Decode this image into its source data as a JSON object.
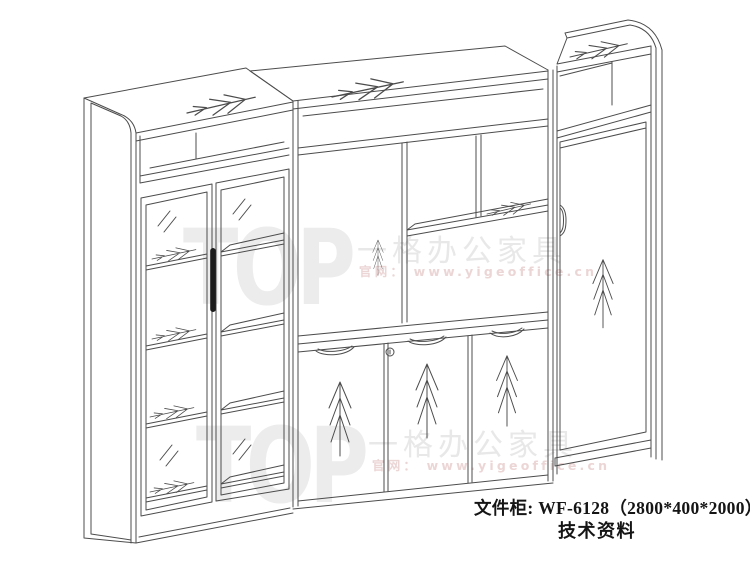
{
  "page": {
    "background_color": "#ffffff"
  },
  "figure": {
    "kind": "furniture technical line drawing",
    "item_label": "文件柜",
    "model": "WF-6128",
    "dimensions": "2800*400*2000",
    "sections": [
      {
        "name": "left-glass-door-bookcase"
      },
      {
        "name": "middle-open-shelves-with-three-door-base-cabinet"
      },
      {
        "name": "right-tall-single-door-cabinet"
      }
    ]
  },
  "caption": {
    "line1": "文件柜: WF-6128（2800*400*2000）",
    "line2": "技术资料"
  },
  "watermark": {
    "logo": "TOP",
    "brand": "一格办公家具",
    "site": "官网： www.yigeoffice.cn"
  },
  "icons": {
    "wood_grain_arrow": "feather-arrow",
    "pine_grain": "pine-tree-grain",
    "glass_reflection": "double-slash",
    "door_handle": "vertical-bar-handle",
    "lock": "keyhole-circle"
  },
  "colors": {
    "line": "#4c4c4c",
    "watermark_gray": "#e8e8e8",
    "watermark_pink": "#ecd5d5",
    "handle": "#1c1c1c"
  }
}
